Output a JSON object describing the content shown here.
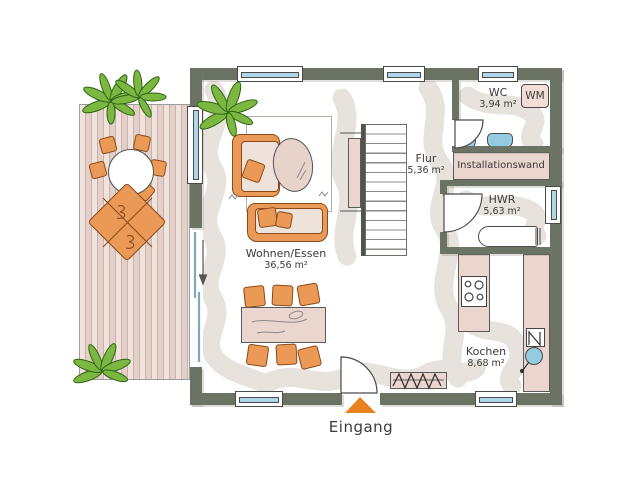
{
  "rooms": {
    "wohnen": {
      "name": "Wohnen/Essen",
      "area": "36,56 m²"
    },
    "flur": {
      "name": "Flur",
      "area": "5,36 m²"
    },
    "wc": {
      "name": "WC",
      "area": "3,94 m²"
    },
    "hwr": {
      "name": "HWR",
      "area": "5,63 m²"
    },
    "kochen": {
      "name": "Kochen",
      "area": "8,68 m²"
    }
  },
  "labels": {
    "installationswand": "Installationswand",
    "washing_machine": "WM",
    "entrance": "Eingang"
  },
  "colors": {
    "wall": "#6b7365",
    "window_glass": "#aed6e8",
    "furniture_orange": "#ea9a56",
    "furniture_outline": "#8a4a1a",
    "surface_pink": "#ead6ce",
    "fixture_blue": "#93cbe2",
    "path_gray": "#e7e3dc",
    "plant_green": "#7cb742",
    "plant_dark": "#2e6414",
    "entrance_orange": "#e8821e",
    "text": "#3b3b3b"
  }
}
